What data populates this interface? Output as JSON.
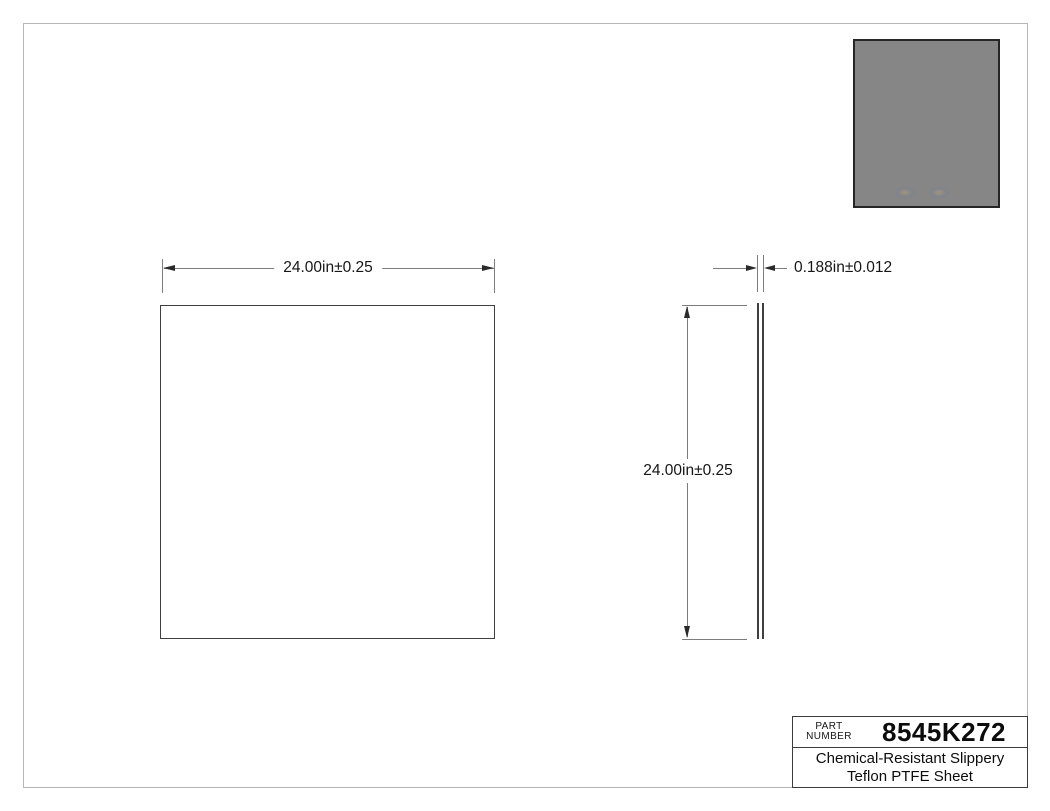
{
  "dimensions": {
    "front_width": "24.00in±0.25",
    "side_height": "24.00in±0.25",
    "side_thickness": "0.188in±0.012"
  },
  "title_block": {
    "part_label_line1": "PART",
    "part_label_line2": "NUMBER",
    "part_number": "8545K272",
    "description_line1": "Chemical-Resistant Slippery",
    "description_line2": "Teflon PTFE Sheet"
  },
  "colors": {
    "page_border": "#b6b6b6",
    "object_line": "#3f3f3f",
    "dimension_line": "#7d7d7d",
    "text": "#161616",
    "thumbnail_fill": "#868686",
    "thumbnail_border": "#262626"
  }
}
